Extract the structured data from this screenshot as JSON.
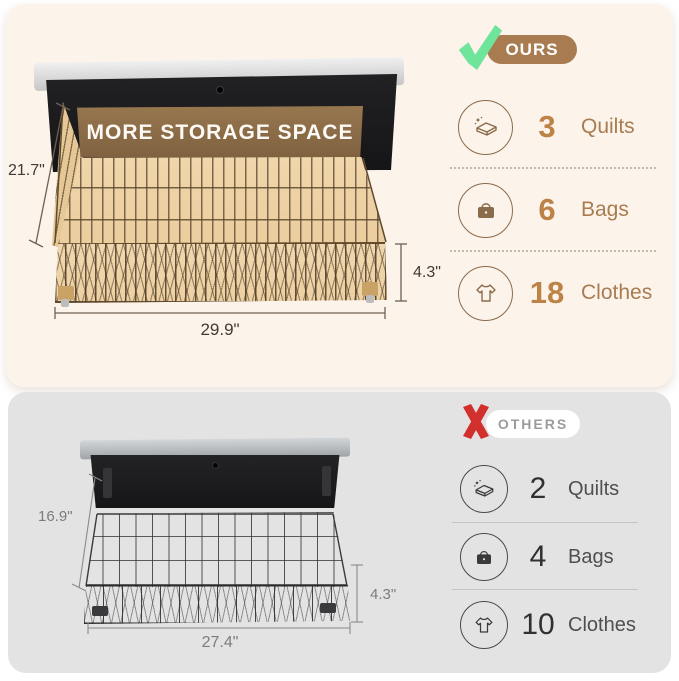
{
  "ours": {
    "badge_label": "OURS",
    "banner_text": "MORE STORAGE SPACE",
    "dimensions": {
      "depth_left": "21.7\"",
      "width_bottom": "29.9\"",
      "height_right": "4.3\""
    },
    "capacity": [
      {
        "icon": "quilt-icon",
        "count": "3",
        "label": "Quilts"
      },
      {
        "icon": "bag-icon",
        "count": "6",
        "label": "Bags"
      },
      {
        "icon": "tshirt-icon",
        "count": "18",
        "label": "Clothes"
      }
    ]
  },
  "others": {
    "badge_label": "OTHERS",
    "dimensions": {
      "depth_left": "16.9\"",
      "width_bottom": "27.4\"",
      "height_right": "4.3\""
    },
    "capacity": [
      {
        "icon": "quilt-icon",
        "count": "2",
        "label": "Quilts"
      },
      {
        "icon": "bag-icon",
        "count": "4",
        "label": "Bags"
      },
      {
        "icon": "tshirt-icon",
        "count": "10",
        "label": "Clothes"
      }
    ]
  },
  "colors": {
    "ours_card_bg": "#fcf3eb",
    "others_card_bg": "#e3e3e4",
    "ours_accent_brown": "#a87c50",
    "banner_brown": "#8a6a45",
    "check_green": "#6fe49b",
    "x_red": "#d2302c",
    "count_brown": "#bc8246",
    "others_text_gray": "#4f4f4f"
  }
}
